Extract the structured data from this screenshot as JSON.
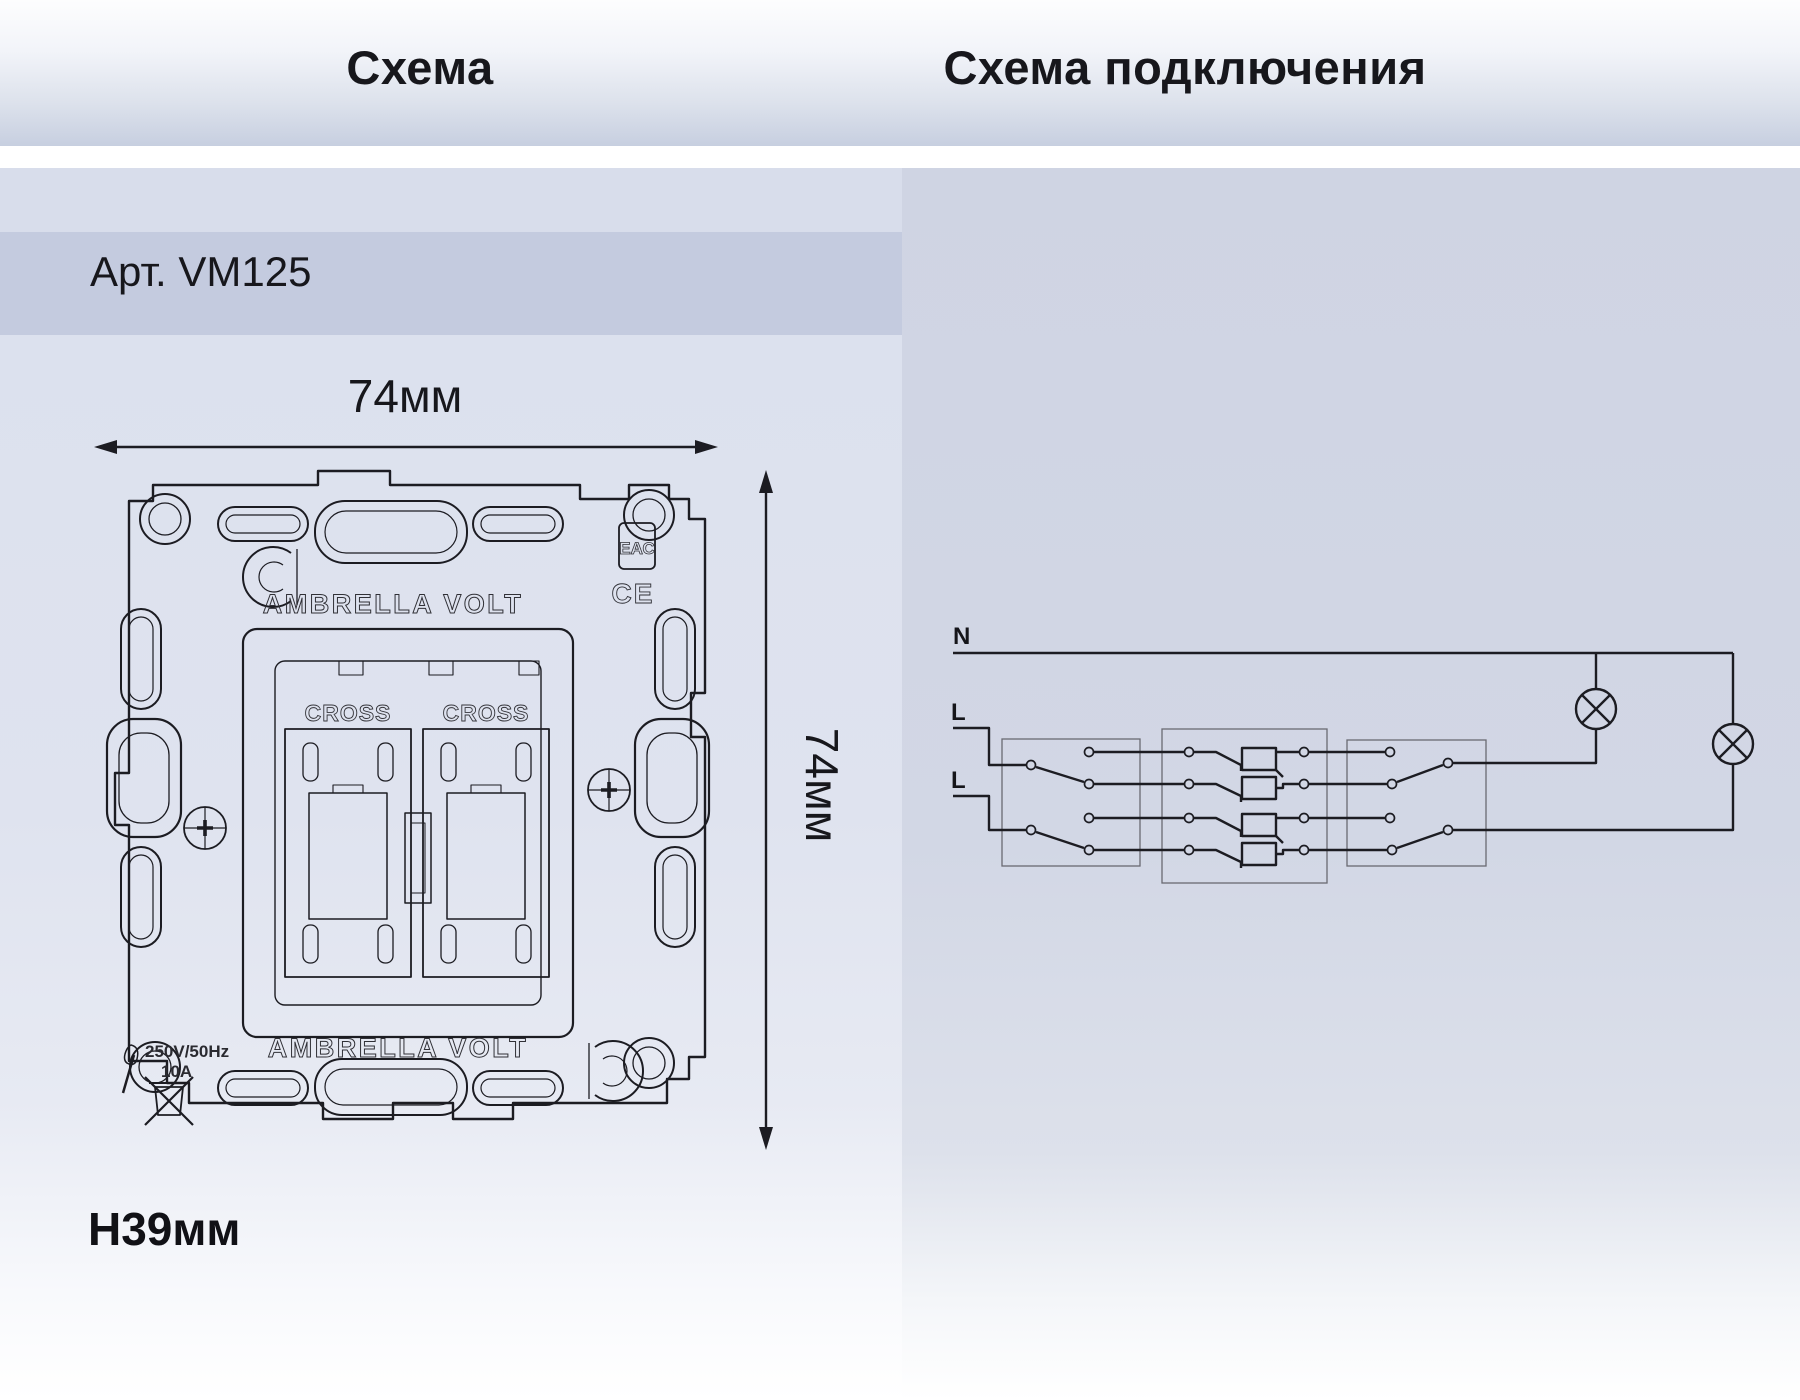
{
  "left": {
    "title": "Схема",
    "article": "Арт. VM125",
    "dims": {
      "width": "74мм",
      "height": "74мм",
      "depth": "H39мм"
    },
    "drawing": {
      "brand_top": "AMBRELLA VOLT",
      "brand_bottom": "AMBRELLA VOLT",
      "cross_left": "CROSS",
      "cross_right": "CROSS",
      "eac_mark": "ЕАС",
      "ce_mark": "CE",
      "rating_voltage": "250V/50Hz",
      "rating_current": "10A"
    }
  },
  "right": {
    "title": "Схема подключения",
    "wiring": {
      "n": "N",
      "l1": "L",
      "l2": "L"
    }
  },
  "colors": {
    "ink": "#1c1c22",
    "engraving": "#303036",
    "thin_box": "#6a6a72",
    "header_from": "#fdfdfe",
    "header_to": "#c7cfe0",
    "left_band": "#d8ddeb",
    "left_stripe": "#c4cbdf",
    "left_body": "#dce1ee",
    "right_body": "#d2d7e5",
    "white_gap": "#ffffff"
  }
}
